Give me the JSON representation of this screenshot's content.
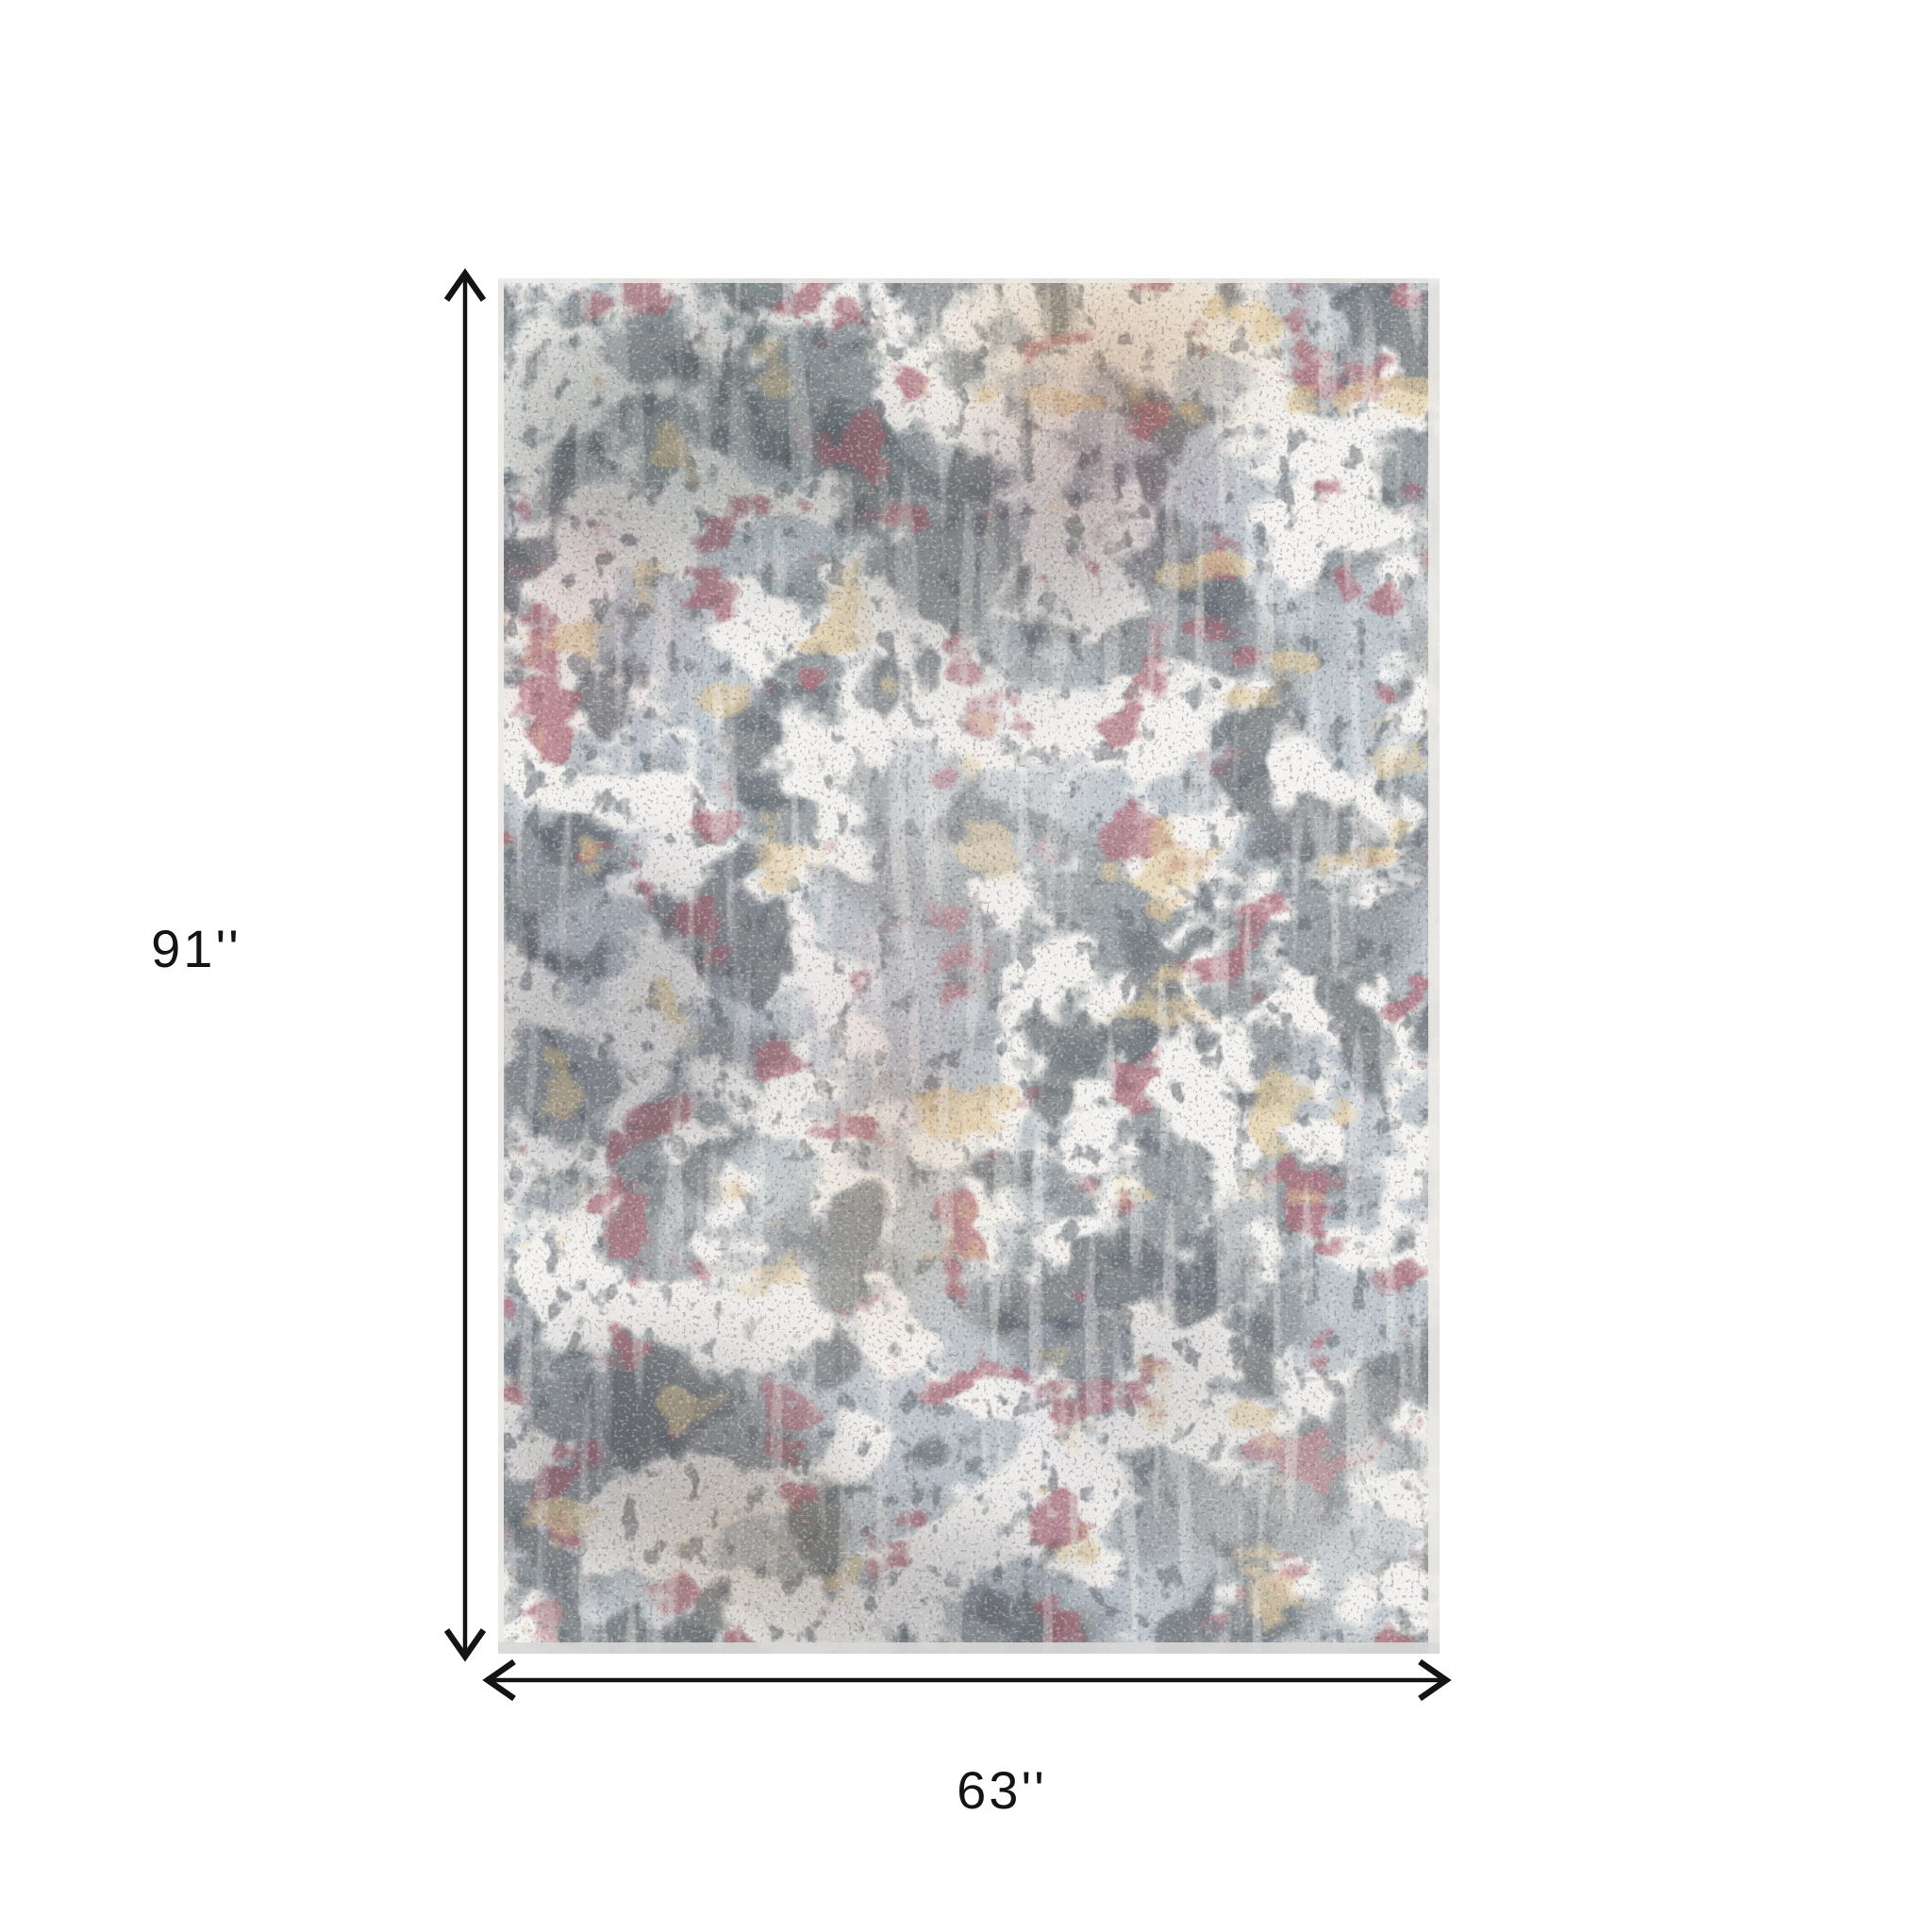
{
  "figure": {
    "type": "product-dimension-diagram",
    "subject": "gray maroon and gold abstract distressed area rug"
  },
  "dimensions": {
    "arrow_color": "#141414",
    "height": {
      "label": "91''"
    },
    "width": {
      "label": "63''"
    }
  },
  "rug": {
    "palette": {
      "base_gray": "#9ba1a5",
      "blue_gray": "#8b98a2",
      "ivory": "#ece9e3",
      "charcoal": "#2e343a",
      "maroon": "#6e2f38",
      "dusty_red": "#9c6057",
      "gold": "#c2985c",
      "edge": "#eceae6",
      "bottom_edge": "#d8d8d7"
    }
  },
  "background_color": "#ffffff"
}
